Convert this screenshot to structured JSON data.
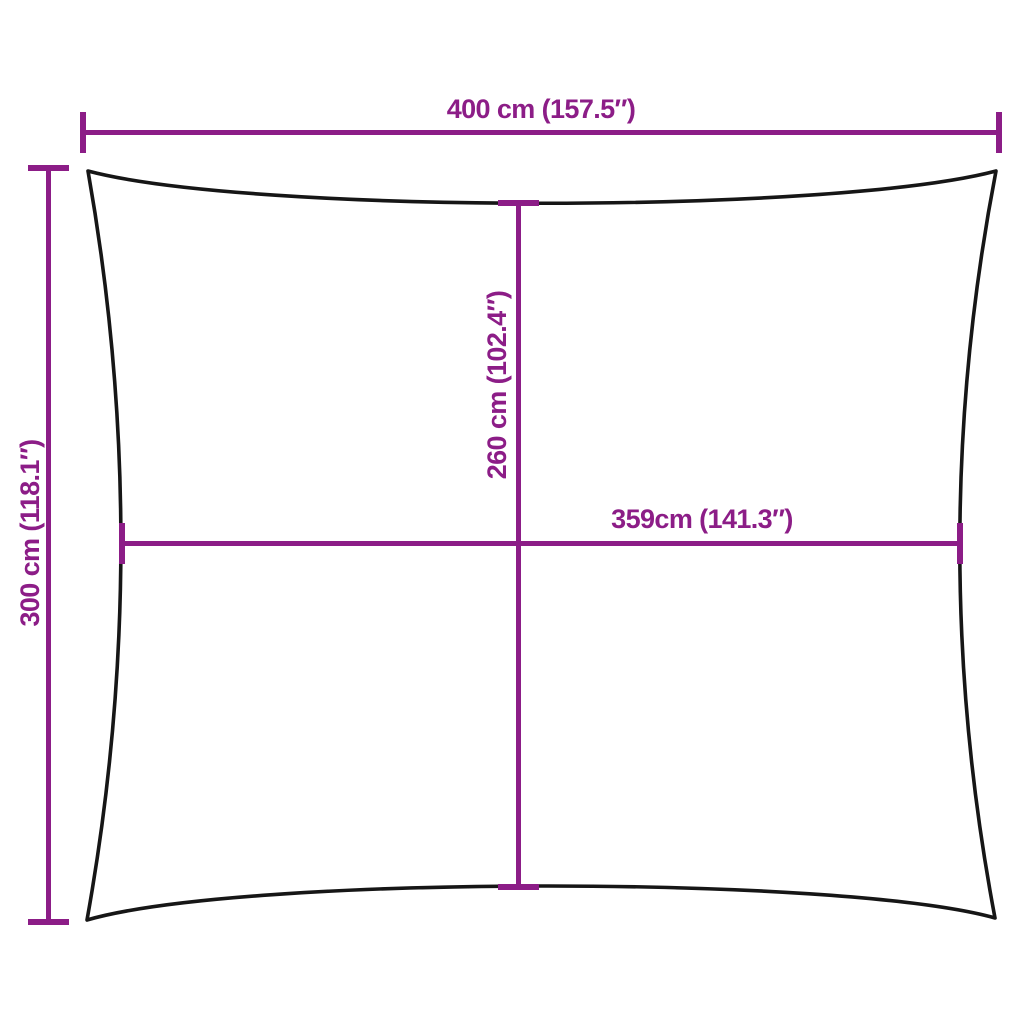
{
  "colors": {
    "dimension": "#8C1D87",
    "outline": "#161616",
    "background": "#ffffff"
  },
  "dimensions": {
    "top_width": {
      "label": "400 cm (157.5″)",
      "cm": 400,
      "inches": 157.5
    },
    "left_height": {
      "label": "300 cm (118.1″)",
      "cm": 300,
      "inches": 118.1
    },
    "inner_height": {
      "label": "260 cm (102.4″)",
      "cm": 260,
      "inches": 102.4
    },
    "inner_width": {
      "label": "359cm (141.3″)",
      "cm": 359,
      "inches": 141.3
    }
  }
}
